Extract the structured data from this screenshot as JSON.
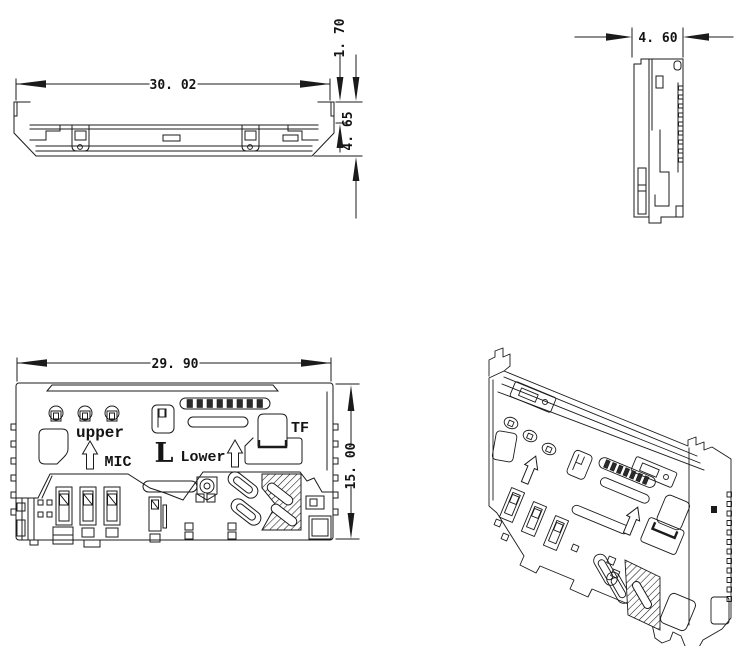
{
  "colors": {
    "line": "#1b1b1b",
    "background": "#ffffff"
  },
  "front_view": {
    "dim_width": "30. 02",
    "dim_step_height": "1. 70",
    "dim_overall_height": "4. 65"
  },
  "side_view": {
    "dim_depth": "4. 60"
  },
  "plan_view": {
    "dim_width": "29. 90",
    "dim_height": "15. 00",
    "labels": {
      "upper": "upper",
      "mic": "MIC",
      "l": "L",
      "lower": "Lower",
      "tf": "TF"
    }
  }
}
